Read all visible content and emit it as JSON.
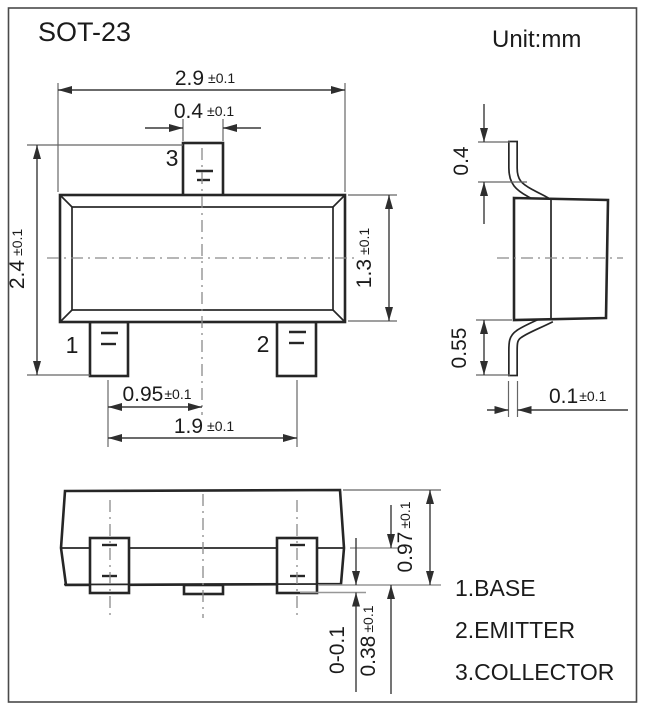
{
  "title": "SOT-23",
  "unit_label": "Unit:mm",
  "pins": {
    "pin1_label": "1",
    "pin2_label": "2",
    "pin3_label": "3"
  },
  "legend": {
    "items": [
      "1.BASE",
      "2.EMITTER",
      "3.COLLECTOR"
    ]
  },
  "dimensions": {
    "body_width": {
      "value": "2.9",
      "tol": "±0.1"
    },
    "tab_width": {
      "value": "0.4",
      "tol": "±0.1"
    },
    "overall_height": {
      "value": "2.4",
      "tol": "±0.1"
    },
    "body_height": {
      "value": "1.3",
      "tol": "±0.1"
    },
    "pin_pitch": {
      "value": "0.95",
      "tol": "±0.1"
    },
    "pin_span": {
      "value": "1.9",
      "tol": "±0.1"
    },
    "lead_top_height": {
      "value": "0.4"
    },
    "lead_bottom_height": {
      "value": "0.55"
    },
    "lead_thickness": {
      "value": "0.1",
      "tol": "±0.1"
    },
    "lead_length": {
      "value": "0.97",
      "tol": "±0.1"
    },
    "standoff": {
      "value": "0-0.1"
    },
    "lead_width": {
      "value": "0.38",
      "tol": "±0.1"
    }
  },
  "colors": {
    "line": "#262626",
    "dimension": "#3a3a3a",
    "centerline": "#8a8a8a",
    "background": "#ffffff"
  }
}
